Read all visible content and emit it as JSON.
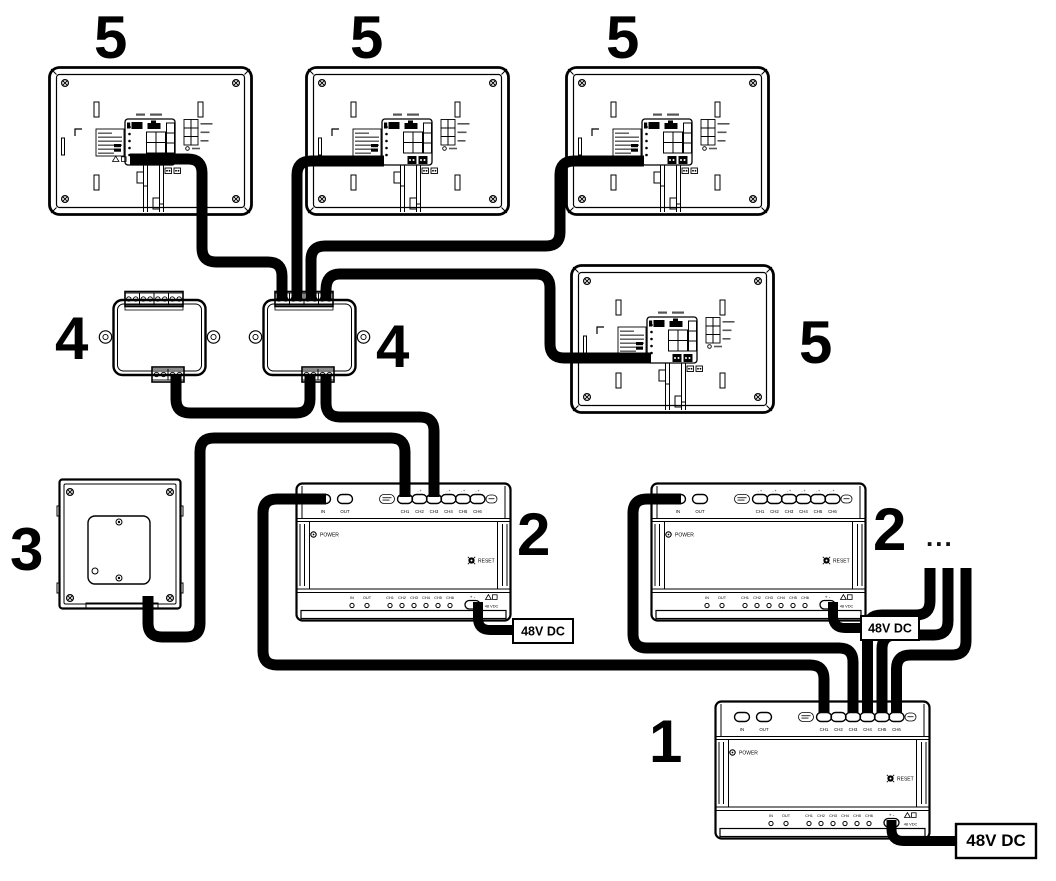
{
  "callouts": {
    "monitor": "5",
    "junction_box": "4",
    "door_station": "3",
    "floor_distributor": "2",
    "main_distributor": "1",
    "more_indicator": "..."
  },
  "distributor": {
    "in_label": "IN",
    "out_label": "OUT",
    "channel_labels": [
      "CH1",
      "CH2",
      "CH3",
      "CH4",
      "CH5",
      "CH6"
    ],
    "power_label": "POWER",
    "reset_label": "RESET",
    "terminal_pair_label": "- +",
    "dc_terminal_label": "+ -",
    "dc_rating_label": "48 VDC"
  },
  "power_supply_label": "48V DC",
  "colors": {
    "line": "#000000",
    "background": "#ffffff"
  }
}
